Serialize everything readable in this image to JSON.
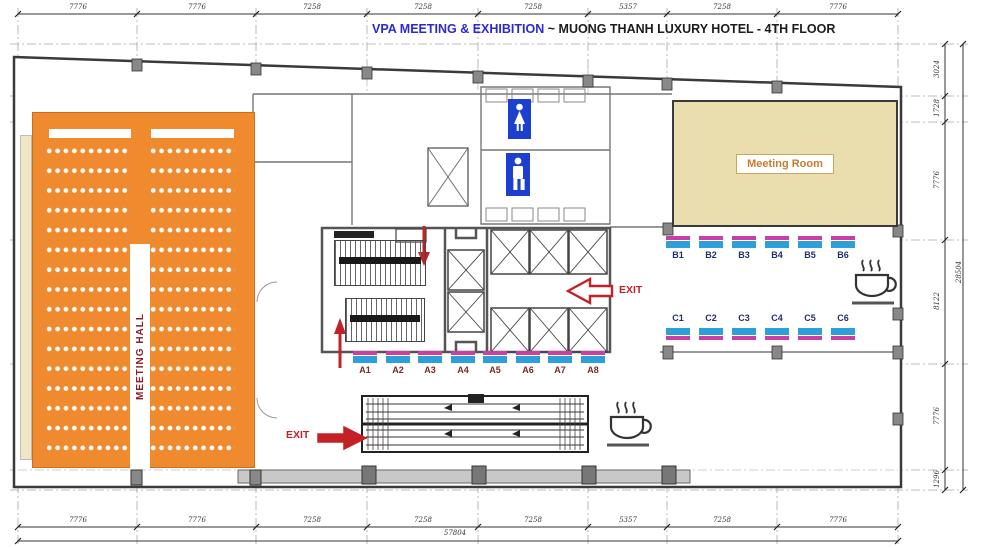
{
  "title": {
    "event": "VPA MEETING & EXHIBITION",
    "separator": "~",
    "venue": "MUONG THANH LUXURY HOTEL - 4TH FLOOR"
  },
  "rooms": {
    "meeting_hall": "MEETING HALL",
    "meeting_room": "Meeting Room"
  },
  "exit_label": "EXIT",
  "booths": {
    "row_a": [
      "A1",
      "A2",
      "A3",
      "A4",
      "A5",
      "A6",
      "A7",
      "A8"
    ],
    "row_b": [
      "B1",
      "B2",
      "B3",
      "B4",
      "B5",
      "B6"
    ],
    "row_c": [
      "C1",
      "C2",
      "C3",
      "C4",
      "C5",
      "C6"
    ]
  },
  "dimensions": {
    "top": [
      "7776",
      "7776",
      "7258",
      "7258",
      "7258",
      "5357",
      "7258",
      "7776"
    ],
    "bottom": [
      "7776",
      "7776",
      "7258",
      "7258",
      "7258",
      "5357",
      "7258",
      "7776"
    ],
    "bottom_total": "57804",
    "right": [
      "3024",
      "1728",
      "7776",
      "8122",
      "7776",
      "1296"
    ],
    "right_total": "28504"
  },
  "colors": {
    "hall_orange": "#EF8A2E",
    "room_beige": "#EADDAE",
    "booth_blue": "#2D9FDB",
    "booth_magenta": "#C93FA4",
    "exit_red": "#C42126",
    "restroom_blue": "#1C3FCE",
    "title_blue": "#2A2AD4",
    "hall_label_red": "#8A1F2B"
  }
}
